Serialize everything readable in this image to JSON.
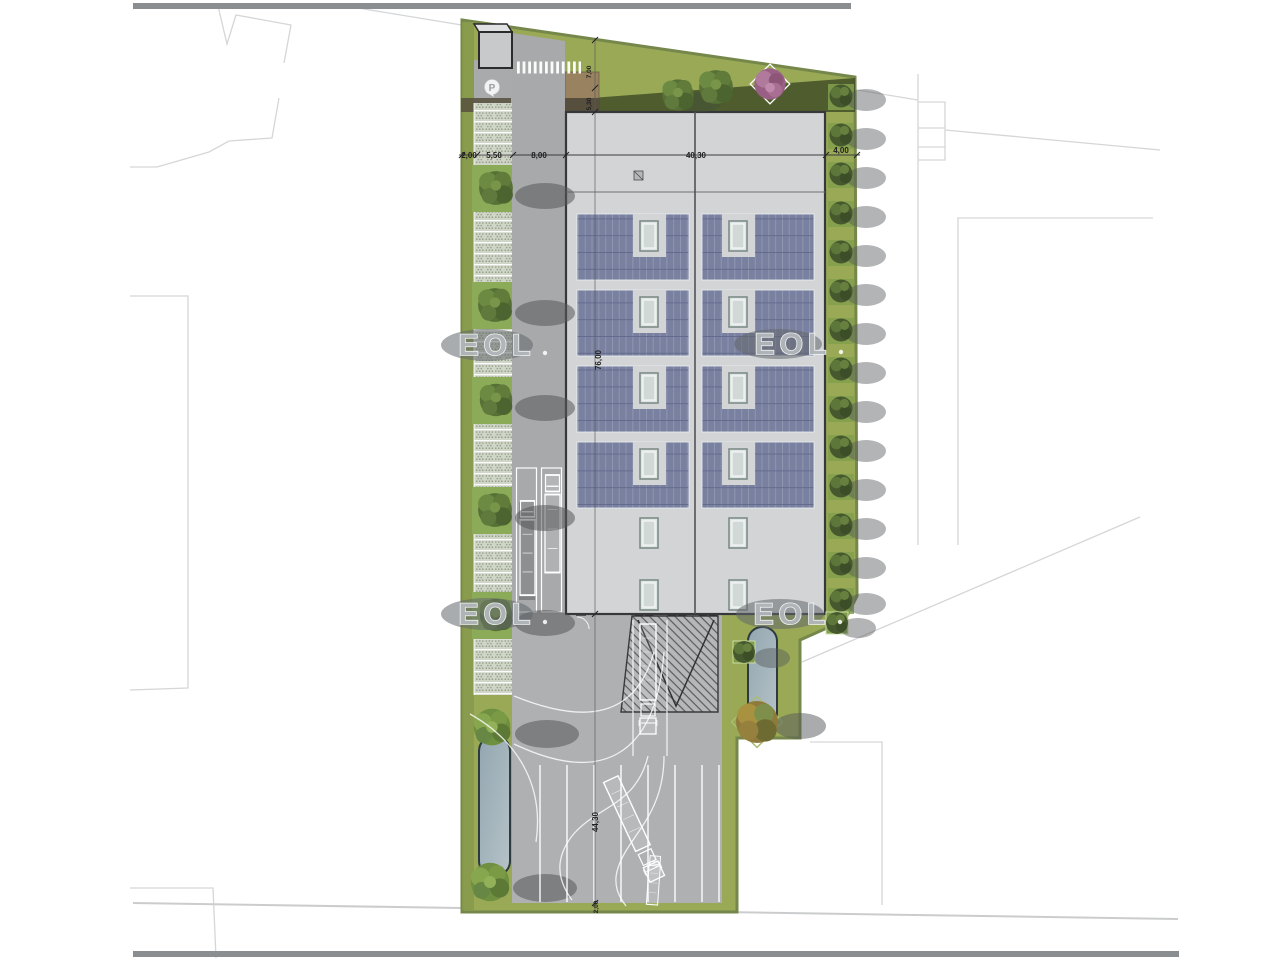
{
  "plan": {
    "watermark": {
      "brand": "EOL"
    },
    "parking_sign": "P",
    "dimensions": {
      "left_margin": "2,00",
      "parking_depth": "5,50",
      "driveway_width": "8,00",
      "building_width": "40,30",
      "right_margin": "4,00",
      "north_setback": "7,00",
      "entry_walk": "5,30",
      "building_length": "76,00",
      "yard_length": "44,30",
      "south_margin": "2,00"
    },
    "colors": {
      "site_green": "#99a956",
      "building_gray": "#d2d4d6",
      "solar_panel": "#7a81a0",
      "pavement": "#aeb0b2",
      "driveway": "#a7a9ab",
      "water_dark": "#93a6b0",
      "watermark_gray": "#b2b7bb"
    }
  }
}
